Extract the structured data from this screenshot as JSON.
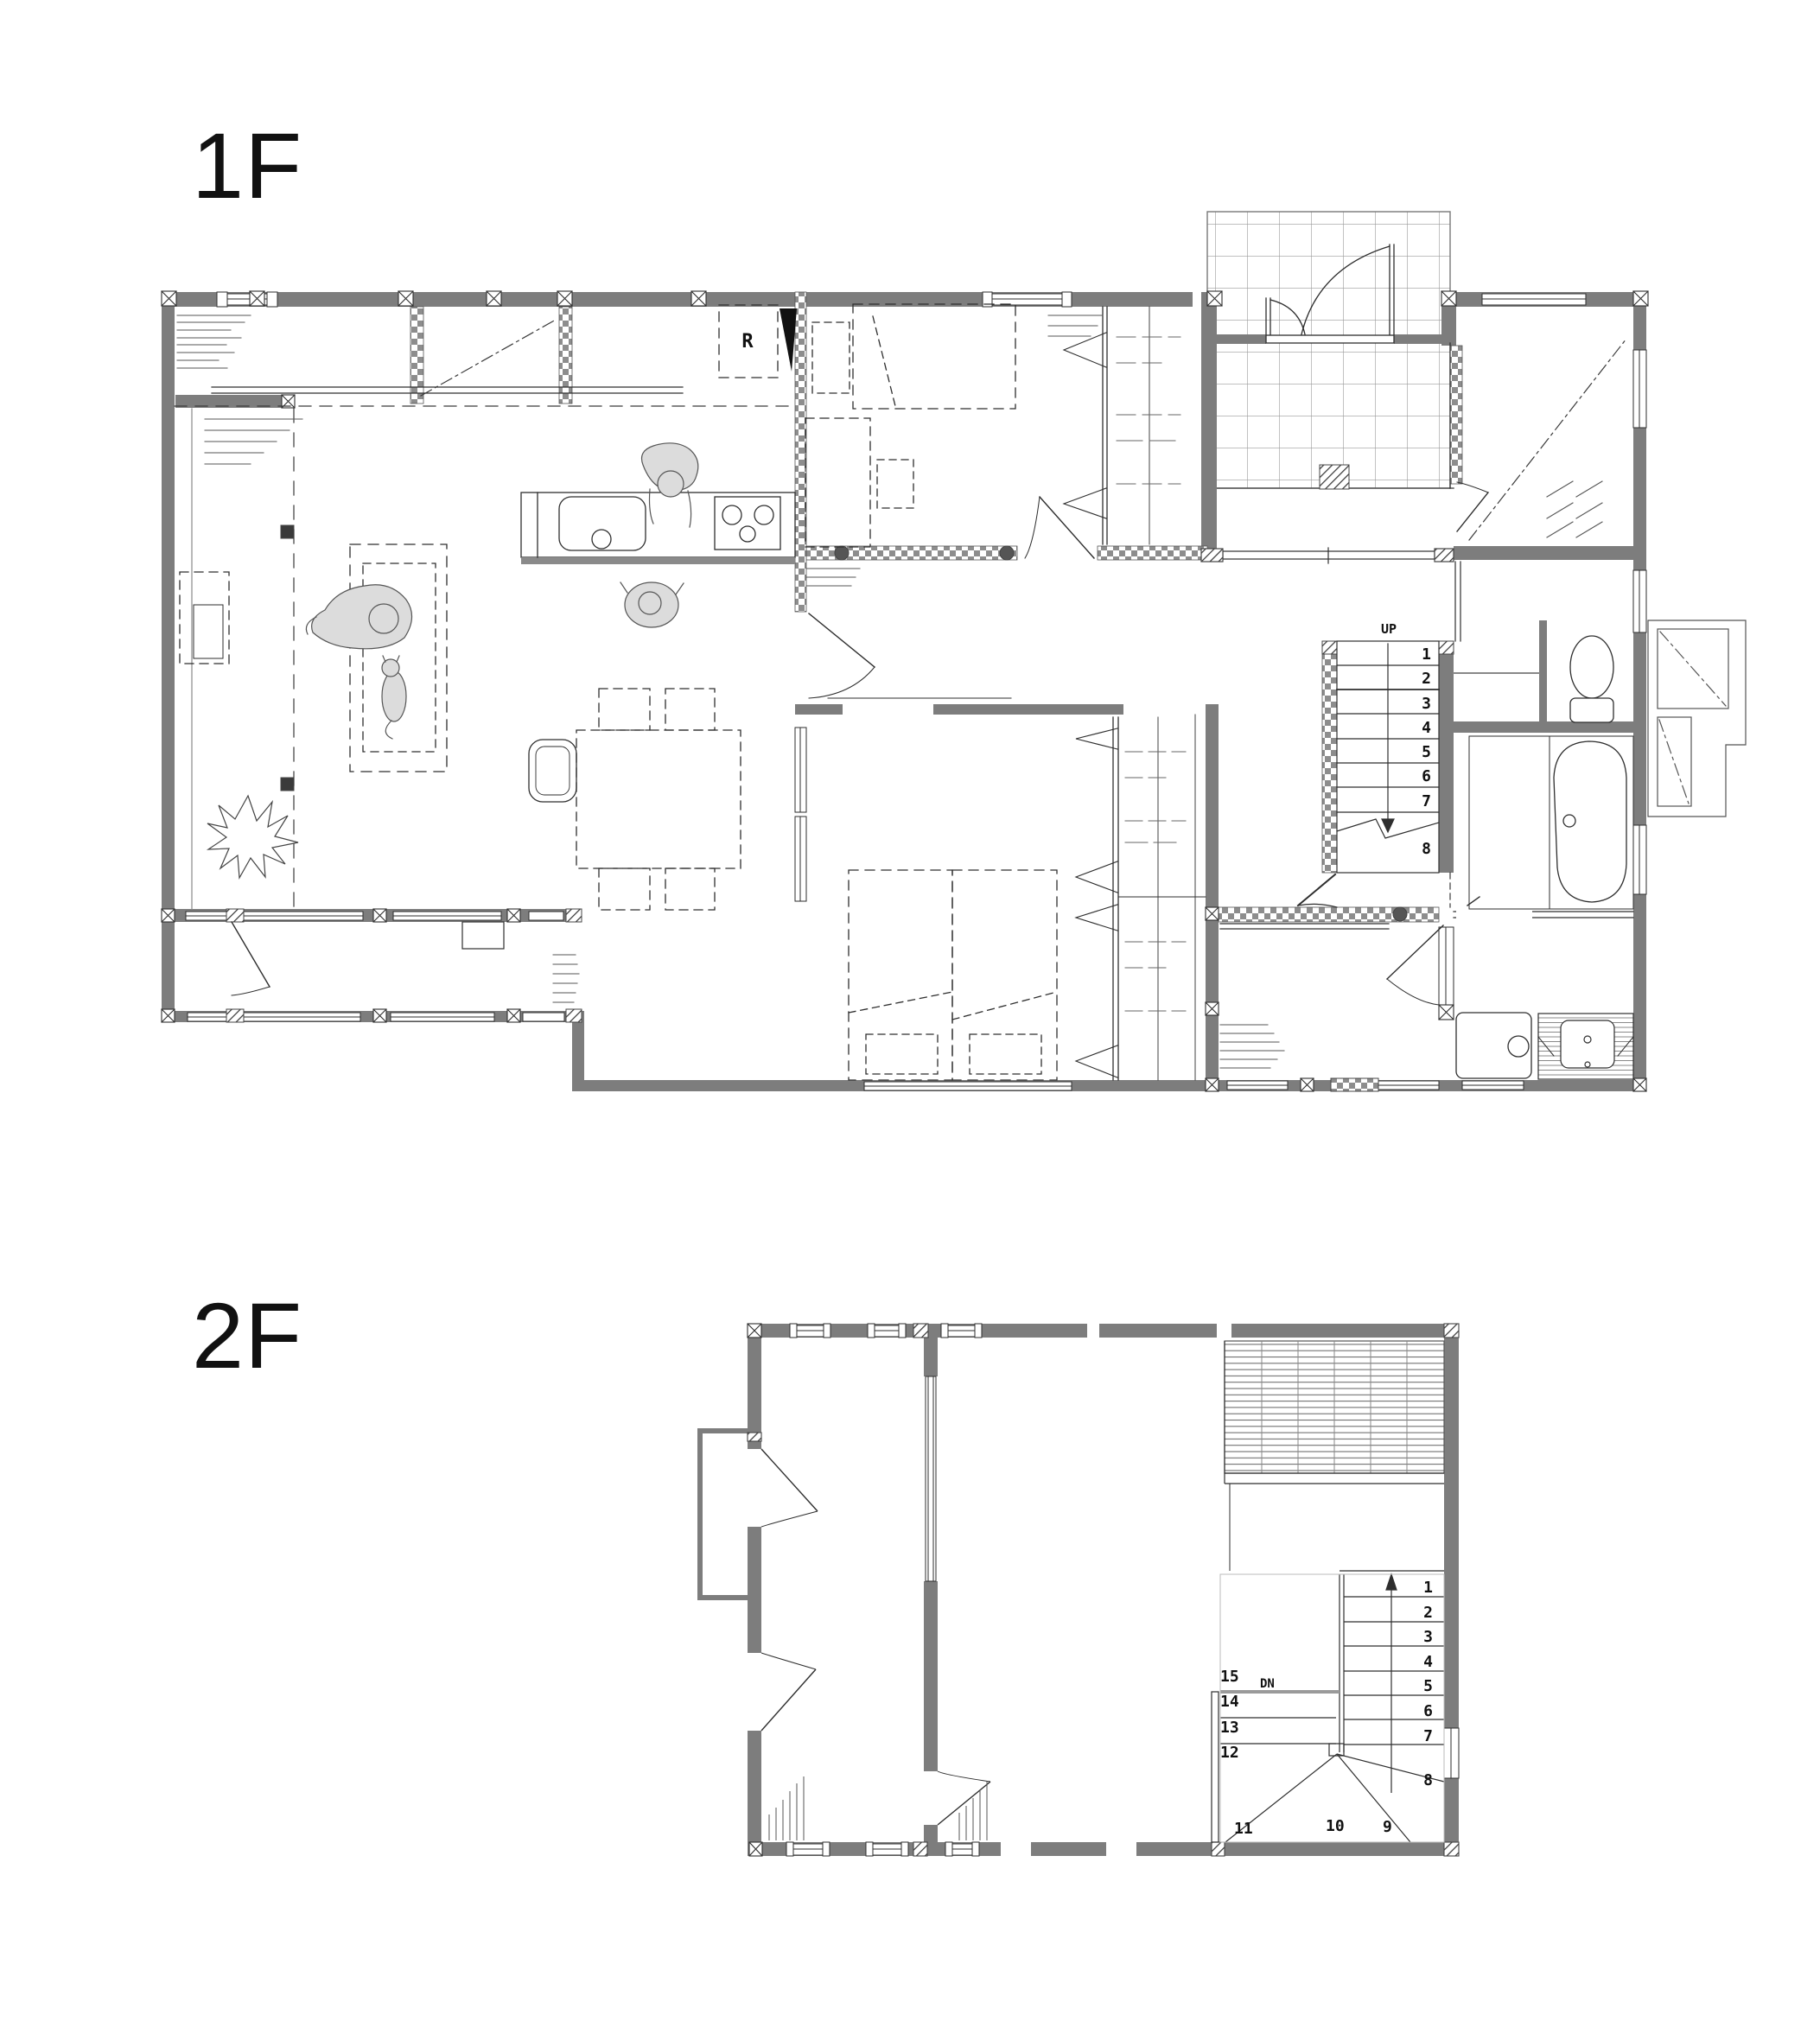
{
  "floors": {
    "floor1": {
      "label": "1F"
    },
    "floor2": {
      "label": "2F"
    }
  },
  "annotations": {
    "refrigerator_label": "R",
    "stairs_up_label": "UP",
    "stairs_down_label": "DN"
  },
  "stairs_1f": {
    "steps_1_7": [
      "1",
      "2",
      "3",
      "4",
      "5",
      "6",
      "7"
    ],
    "step_8": "8"
  },
  "stairs_2f": {
    "steps_1_7": [
      "1",
      "2",
      "3",
      "4",
      "5",
      "6",
      "7"
    ],
    "step_8": "8",
    "steps_bottom": [
      "11",
      "10",
      "9"
    ],
    "steps_15_12": [
      "15",
      "14",
      "13",
      "12"
    ]
  },
  "colors": {
    "wall_gray": "#7d7d7d",
    "line_dark": "#2e2e2e",
    "figure_fill": "#dcdcdc",
    "tile_line": "#a8a8a8"
  }
}
